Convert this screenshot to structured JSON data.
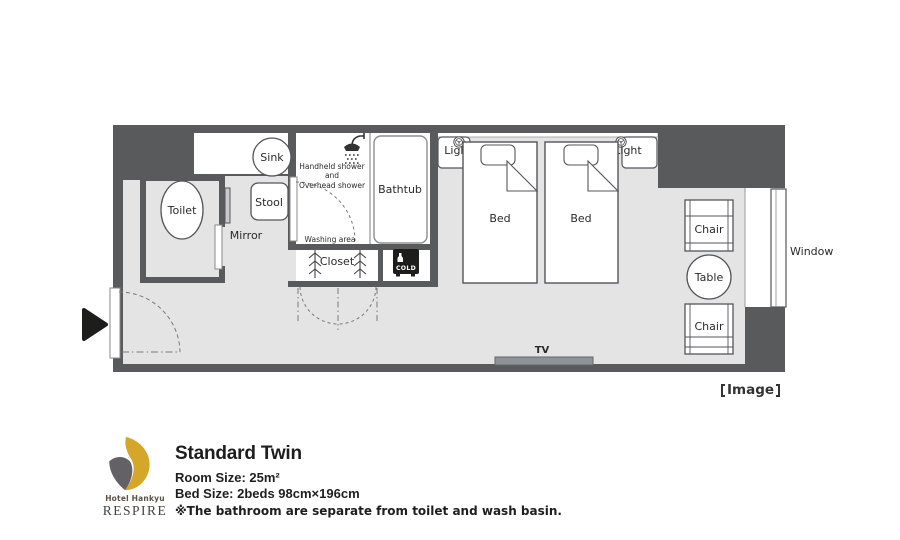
{
  "colors": {
    "wall": "#595a5c",
    "floor": "#e4e4e5",
    "black_item": "#1d1d1b",
    "tv_gray": "#8f9296",
    "logo_gold": "#d4a62a",
    "logo_gray": "#636066"
  },
  "plan": {
    "labels": {
      "sink": "Sink",
      "toilet": "Toilet",
      "stool": "Stool",
      "mirror": "Mirror",
      "shower_line1": "Handheld shower",
      "shower_line2": "and",
      "shower_line3": "Overhead shower",
      "washing_area": "Washing area",
      "bathtub": "Bathtub",
      "closet": "Closet",
      "fridge": "COLD",
      "light_left": "Light",
      "light_right": "Light",
      "bed_left": "Bed",
      "bed_right": "Bed",
      "chair_top": "Chair",
      "table": "Table",
      "chair_bottom": "Chair",
      "window": "Window",
      "tv": "TV"
    },
    "caption": "Image"
  },
  "info": {
    "room_name": "Standard Twin",
    "room_size": "Room Size: 25m²",
    "bed_size": "Bed Size: 2beds 98cm×196cm",
    "note": "※The bathroom are separate from toilet and wash basin."
  },
  "brand": {
    "hotel": "Hotel Hankyu",
    "name": "RESPIRE"
  }
}
